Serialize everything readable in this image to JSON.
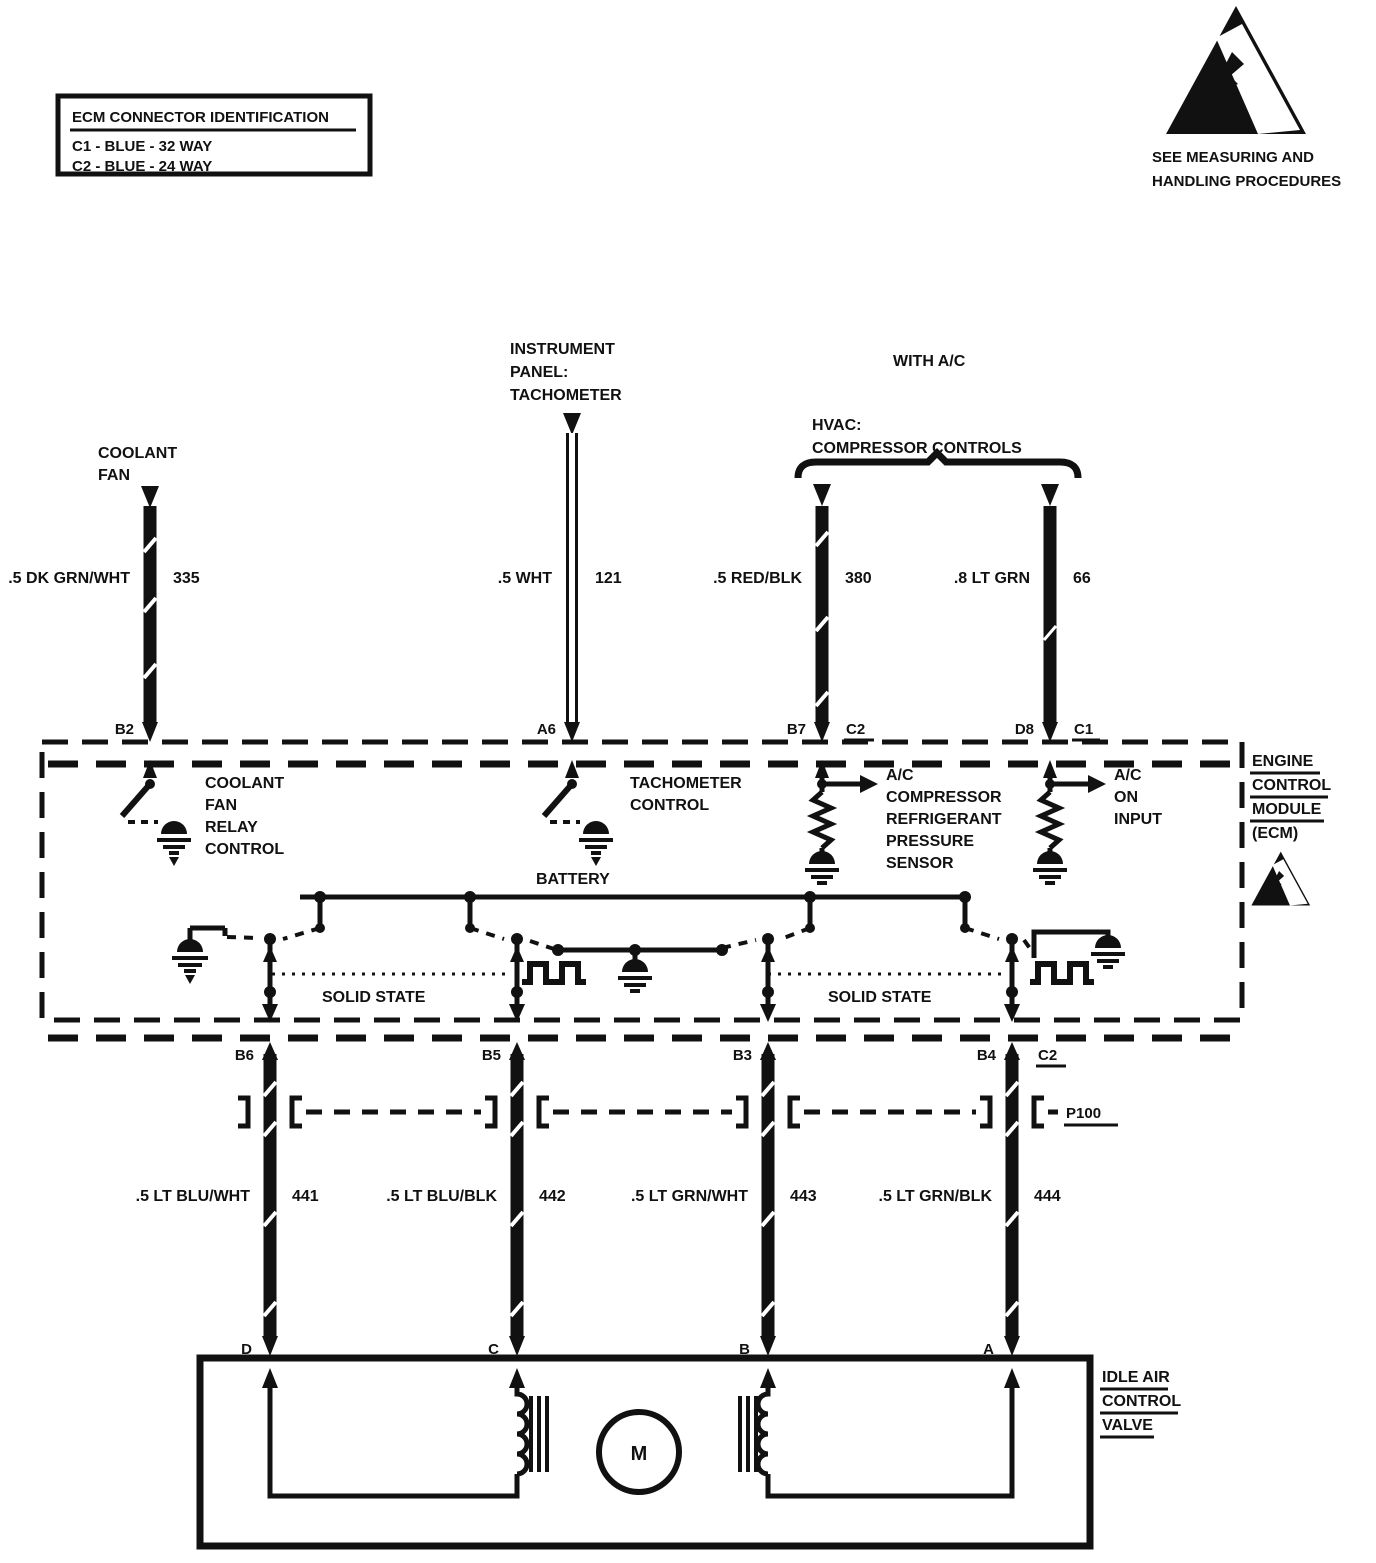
{
  "legend": {
    "title": "ECM CONNECTOR IDENTIFICATION",
    "line1": "C1 - BLUE - 32 WAY",
    "line2": "C2 - BLUE - 24 WAY"
  },
  "esd_note": {
    "line1": "SEE MEASURING AND",
    "line2": "HANDLING PROCEDURES"
  },
  "labels": {
    "coolant_fan": {
      "l1": "COOLANT",
      "l2": "FAN"
    },
    "instrument_panel": {
      "l1": "INSTRUMENT",
      "l2": "PANEL:",
      "l3": "TACHOMETER"
    },
    "with_ac": "WITH A/C",
    "hvac": {
      "l1": "HVAC:",
      "l2": "COMPRESSOR CONTROLS"
    }
  },
  "top_wires": {
    "coolant": {
      "color": ".5 DK GRN/WHT",
      "circuit": "335",
      "pin": "B2"
    },
    "tach": {
      "color": ".5 WHT",
      "circuit": "121",
      "pin": "A6"
    },
    "ac_pressure": {
      "color": ".5 RED/BLK",
      "circuit": "380",
      "pin": "B7",
      "connector": "C2"
    },
    "ac_on": {
      "color": ".8 LT GRN",
      "circuit": "66",
      "pin": "D8",
      "connector": "C1"
    }
  },
  "ecm": {
    "title": {
      "l1": "ENGINE",
      "l2": "CONTROL",
      "l3": "MODULE",
      "l4": "(ECM)"
    },
    "coolant_fan_relay": {
      "l1": "COOLANT",
      "l2": "FAN",
      "l3": "RELAY",
      "l4": "CONTROL"
    },
    "tach_control": {
      "l1": "TACHOMETER",
      "l2": "CONTROL"
    },
    "battery": "BATTERY",
    "ac_pressure_sensor": {
      "l1": "A/C",
      "l2": "COMPRESSOR",
      "l3": "REFRIGERANT",
      "l4": "PRESSURE",
      "l5": "SENSOR"
    },
    "ac_on_input": {
      "l1": "A/C",
      "l2": "ON",
      "l3": "INPUT"
    },
    "solid_state_left": "SOLID STATE",
    "solid_state_right": "SOLID STATE"
  },
  "lower_pins": {
    "p1": "B6",
    "p2": "B5",
    "p3": "B3",
    "p4": "B4",
    "connector": "C2"
  },
  "inline_connector": "P100",
  "lower_wires": {
    "w1": {
      "color": ".5 LT BLU/WHT",
      "circuit": "441",
      "pin": "D"
    },
    "w2": {
      "color": ".5 LT BLU/BLK",
      "circuit": "442",
      "pin": "C"
    },
    "w3": {
      "color": ".5 LT GRN/WHT",
      "circuit": "443",
      "pin": "B"
    },
    "w4": {
      "color": ".5 LT GRN/BLK",
      "circuit": "444",
      "pin": "A"
    }
  },
  "iac": {
    "title": {
      "l1": "IDLE AIR",
      "l2": "CONTROL",
      "l3": "VALVE"
    },
    "motor": "M"
  },
  "colors": {
    "ink": "#111111",
    "paper": "#ffffff"
  }
}
